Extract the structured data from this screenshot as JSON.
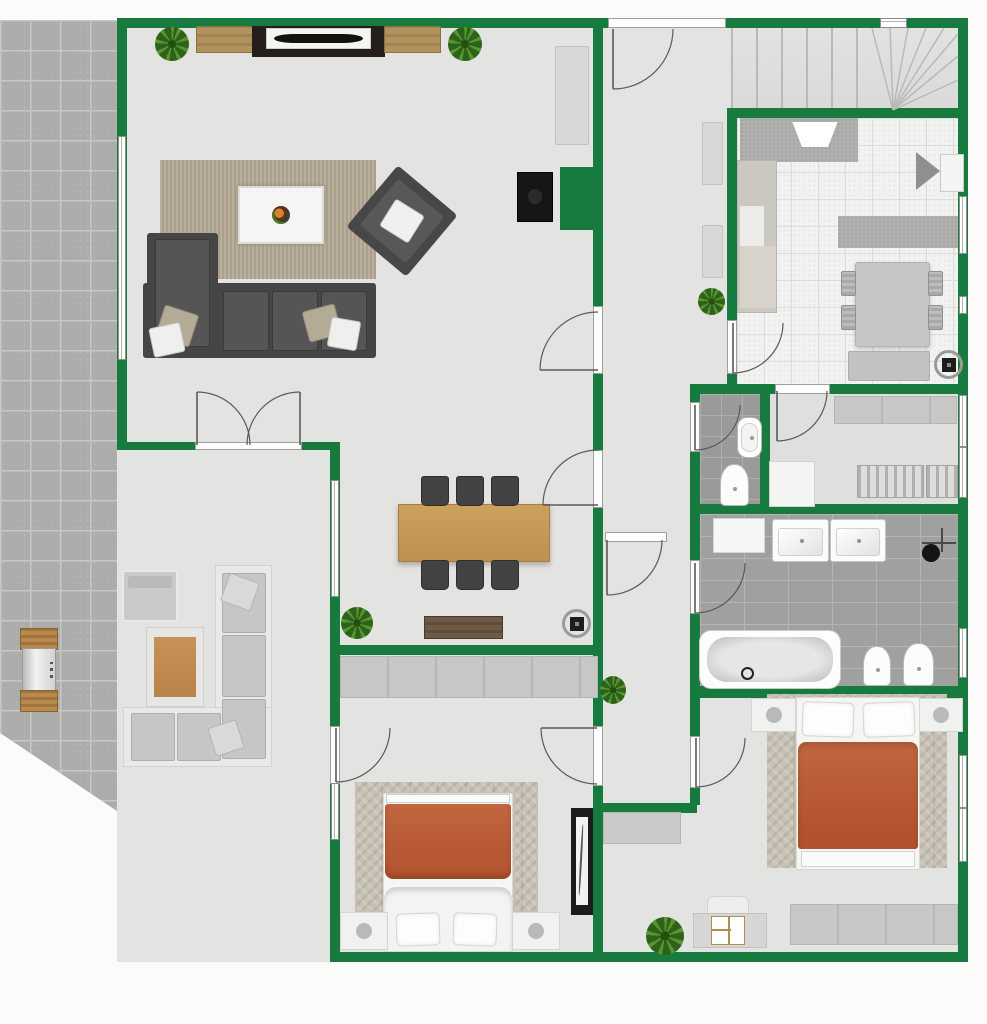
{
  "canvas": {
    "w": 987,
    "h": 1024,
    "bg": "#fbfbfa",
    "wall_color": "#177b40",
    "accent_duvet": "#b85d3a",
    "wood": "#c49a58"
  },
  "plan": {
    "patio": {
      "name": "patio-paving",
      "x": 0,
      "y": 20,
      "w": 340,
      "h": 942,
      "clip": "polygon(0px 0px,117px 0px,117px 424px,330px 424px,330px 933px,0px 713px)"
    },
    "floors": [
      {
        "n": "house-floor-base",
        "x": 117,
        "y": 18,
        "w": 851,
        "h": 944,
        "k": "fl-plain"
      },
      {
        "n": "kitchen-floor",
        "x": 737,
        "y": 118,
        "w": 221,
        "h": 266,
        "k": "fl-kitchen"
      },
      {
        "n": "wc-floor",
        "x": 700,
        "y": 394,
        "w": 60,
        "h": 110,
        "k": "fl-wc"
      },
      {
        "n": "closet-room-floor",
        "x": 770,
        "y": 394,
        "w": 188,
        "h": 110,
        "k": "fl-closet"
      },
      {
        "n": "bathroom-floor",
        "x": 700,
        "y": 514,
        "w": 258,
        "h": 172,
        "k": "fl-bath"
      },
      {
        "n": "staircase-floor",
        "x": 731,
        "y": 28,
        "w": 227,
        "h": 80,
        "k": "fl-stairs"
      },
      {
        "n": "stair-treads",
        "x": 731,
        "y": 28,
        "w": 148,
        "h": 80,
        "k": "fl-stairs treads"
      }
    ],
    "stair_rays": {
      "pivot": [
        893,
        110
      ],
      "tips": [
        [
          872,
          28
        ],
        [
          890,
          28
        ],
        [
          908,
          28
        ],
        [
          926,
          28
        ],
        [
          944,
          28
        ],
        [
          958,
          34
        ],
        [
          958,
          56
        ],
        [
          958,
          80
        ]
      ]
    },
    "walls": [
      {
        "n": "wall-top",
        "x": 117,
        "y": 18,
        "w": 851,
        "h": 10
      },
      {
        "n": "wall-right",
        "x": 958,
        "y": 18,
        "w": 10,
        "h": 944
      },
      {
        "n": "wall-bottom",
        "x": 330,
        "y": 952,
        "w": 638,
        "h": 10
      },
      {
        "n": "wall-living-left",
        "x": 117,
        "y": 18,
        "w": 10,
        "h": 432
      },
      {
        "n": "wall-living-bottom",
        "x": 117,
        "y": 442,
        "w": 221,
        "h": 8
      },
      {
        "n": "wall-west-lower",
        "x": 330,
        "y": 442,
        "w": 10,
        "h": 510
      },
      {
        "n": "wall-hall-west",
        "x": 593,
        "y": 18,
        "w": 10,
        "h": 934
      },
      {
        "n": "wall-fireplace-pier",
        "x": 560,
        "y": 167,
        "w": 43,
        "h": 63
      },
      {
        "n": "wall-bedleft-top",
        "x": 330,
        "y": 645,
        "w": 273,
        "h": 10
      },
      {
        "n": "wall-corridor-end",
        "x": 603,
        "y": 803,
        "w": 94,
        "h": 10
      },
      {
        "n": "wall-stairs-bottom",
        "x": 727,
        "y": 108,
        "w": 241,
        "h": 10
      },
      {
        "n": "wall-kitchen-west",
        "x": 727,
        "y": 118,
        "w": 10,
        "h": 276
      },
      {
        "n": "wall-kitchen-bottom",
        "x": 690,
        "y": 384,
        "w": 278,
        "h": 10
      },
      {
        "n": "wall-corridor-east",
        "x": 690,
        "y": 394,
        "w": 10,
        "h": 306
      },
      {
        "n": "wall-wc-east",
        "x": 760,
        "y": 394,
        "w": 10,
        "h": 120
      },
      {
        "n": "wall-bath-top",
        "x": 690,
        "y": 504,
        "w": 278,
        "h": 10
      },
      {
        "n": "wall-bath-bottom",
        "x": 690,
        "y": 686,
        "w": 278,
        "h": 12
      },
      {
        "n": "wall-bedright-west",
        "x": 690,
        "y": 698,
        "w": 10,
        "h": 107
      }
    ],
    "thresholds": [
      {
        "n": "entry-door-threshold",
        "x": 608,
        "y": 18,
        "w": 118,
        "h": 10
      },
      {
        "n": "living-door-threshold",
        "x": 593,
        "y": 306,
        "w": 10,
        "h": 68
      },
      {
        "n": "dining-door-threshold",
        "x": 593,
        "y": 450,
        "w": 10,
        "h": 58
      },
      {
        "n": "corridor-door-threshold",
        "x": 605,
        "y": 532,
        "w": 62,
        "h": 10
      },
      {
        "n": "kitchen-door-threshold",
        "x": 727,
        "y": 320,
        "w": 10,
        "h": 54
      },
      {
        "n": "pantry-door-threshold",
        "x": 775,
        "y": 384,
        "w": 55,
        "h": 10
      },
      {
        "n": "wc-door-threshold",
        "x": 690,
        "y": 402,
        "w": 10,
        "h": 50
      },
      {
        "n": "bath-door-threshold",
        "x": 690,
        "y": 560,
        "w": 10,
        "h": 54
      },
      {
        "n": "bedleft-patio-door-threshold",
        "x": 330,
        "y": 726,
        "w": 10,
        "h": 58
      },
      {
        "n": "bedleft-door-threshold",
        "x": 593,
        "y": 726,
        "w": 10,
        "h": 60
      },
      {
        "n": "bedright-door-threshold",
        "x": 690,
        "y": 736,
        "w": 10,
        "h": 52
      },
      {
        "n": "patio-double-door-threshold",
        "x": 195,
        "y": 442,
        "w": 107,
        "h": 8
      }
    ],
    "windows": [
      {
        "n": "living-window",
        "x": 118,
        "y": 136,
        "w": 8,
        "h": 224,
        "o": "v"
      },
      {
        "n": "dining-window",
        "x": 331,
        "y": 480,
        "w": 8,
        "h": 117,
        "o": "v"
      },
      {
        "n": "bedleft-window",
        "x": 331,
        "y": 783,
        "w": 8,
        "h": 57,
        "o": "v"
      },
      {
        "n": "stairs-top-window",
        "x": 880,
        "y": 18,
        "w": 27,
        "h": 10,
        "o": "h"
      },
      {
        "n": "kitchen-window-1",
        "x": 959,
        "y": 196,
        "w": 8,
        "h": 58,
        "o": "v"
      },
      {
        "n": "kitchen-window-2",
        "x": 959,
        "y": 296,
        "w": 8,
        "h": 18,
        "o": "v"
      },
      {
        "n": "closet-window-1",
        "x": 959,
        "y": 395,
        "w": 8,
        "h": 52,
        "o": "v"
      },
      {
        "n": "closet-window-2",
        "x": 959,
        "y": 447,
        "w": 8,
        "h": 51,
        "o": "v"
      },
      {
        "n": "bath-window",
        "x": 959,
        "y": 628,
        "w": 8,
        "h": 50,
        "o": "v"
      },
      {
        "n": "bedright-window-1",
        "x": 959,
        "y": 755,
        "w": 8,
        "h": 53,
        "o": "v"
      },
      {
        "n": "bedright-window-2",
        "x": 959,
        "y": 808,
        "w": 8,
        "h": 54,
        "o": "v"
      }
    ],
    "doors": [
      {
        "n": "entry-door",
        "hx": 613,
        "hy": 29,
        "r": 60,
        "a1": 0,
        "leaf": "end"
      },
      {
        "n": "living-door",
        "hx": 598,
        "hy": 370,
        "r": 58,
        "a1": 180,
        "leaf": "start"
      },
      {
        "n": "dining-door",
        "hx": 598,
        "hy": 505,
        "r": 55,
        "a1": 180,
        "leaf": "start"
      },
      {
        "n": "corridor-door",
        "hx": 607,
        "hy": 540,
        "r": 55,
        "a1": 0,
        "leaf": "end"
      },
      {
        "n": "kitchen-door",
        "hx": 733,
        "hy": 323,
        "r": 50,
        "a1": 0,
        "leaf": "end"
      },
      {
        "n": "pantry-door",
        "hx": 777,
        "hy": 391,
        "r": 50,
        "a1": 0,
        "leaf": "end"
      },
      {
        "n": "wc-door",
        "hx": 695,
        "hy": 405,
        "r": 45,
        "a1": 0,
        "leaf": "end"
      },
      {
        "n": "bathroom-door",
        "hx": 695,
        "hy": 563,
        "r": 50,
        "a1": 0,
        "leaf": "end"
      },
      {
        "n": "bedleft-patio-door",
        "hx": 336,
        "hy": 728,
        "r": 54,
        "a1": 0,
        "leaf": "end"
      },
      {
        "n": "bedleft-door",
        "hx": 597,
        "hy": 728,
        "r": 56,
        "a1": 90,
        "leaf": "end"
      },
      {
        "n": "bedright-door",
        "hx": 696,
        "hy": 738,
        "r": 49,
        "a1": 0,
        "leaf": "end"
      },
      {
        "n": "patio-door-left-leaf",
        "hx": 197,
        "hy": 445,
        "r": 53,
        "a1": 270,
        "leaf": "start"
      },
      {
        "n": "patio-door-right-leaf",
        "hx": 300,
        "hy": 445,
        "r": 53,
        "a1": 180,
        "leaf": "end"
      }
    ],
    "furniture": [
      {
        "t": "plant",
        "n": "living-plant-left",
        "x": 155,
        "y": 27,
        "w": 34,
        "h": 34
      },
      {
        "t": "sideboard-wood",
        "n": "tv-sideboard-left",
        "x": 196,
        "y": 26,
        "w": 57,
        "h": 27
      },
      {
        "t": "media-console",
        "n": "tv-console",
        "x": 252,
        "y": 26,
        "w": 133,
        "h": 31
      },
      {
        "t": "sideboard-wood",
        "n": "tv-sideboard-right",
        "x": 384,
        "y": 26,
        "w": 57,
        "h": 27
      },
      {
        "t": "plant",
        "n": "living-plant-right",
        "x": 448,
        "y": 27,
        "w": 34,
        "h": 34
      },
      {
        "t": "cabinet",
        "n": "living-cabinet",
        "x": 555,
        "y": 46,
        "w": 34,
        "h": 99
      },
      {
        "t": "fireplace",
        "n": "wall-stove",
        "x": 517,
        "y": 172,
        "w": 36,
        "h": 50
      },
      {
        "t": "rug-living",
        "n": "living-rug",
        "x": 160,
        "y": 160,
        "w": 216,
        "h": 119
      },
      {
        "t": "sofa-l",
        "n": "living-sofa",
        "x": 143,
        "y": 233,
        "w": 233,
        "h": 125
      },
      {
        "t": "armchair",
        "n": "living-armchair",
        "x": 363,
        "y": 181,
        "w": 78,
        "h": 80
      },
      {
        "t": "table-wood",
        "n": "dining-table",
        "x": 398,
        "y": 504,
        "w": 152,
        "h": 58
      },
      {
        "t": "chair-dark",
        "n": "dining-chair",
        "x": 421,
        "y": 476,
        "w": 28,
        "h": 30
      },
      {
        "t": "chair-dark",
        "n": "dining-chair",
        "x": 456,
        "y": 476,
        "w": 28,
        "h": 30
      },
      {
        "t": "chair-dark",
        "n": "dining-chair",
        "x": 491,
        "y": 476,
        "w": 28,
        "h": 30
      },
      {
        "t": "chair-dark",
        "n": "dining-chair",
        "x": 421,
        "y": 560,
        "w": 28,
        "h": 30
      },
      {
        "t": "chair-dark",
        "n": "dining-chair",
        "x": 456,
        "y": 560,
        "w": 28,
        "h": 30
      },
      {
        "t": "chair-dark",
        "n": "dining-chair",
        "x": 491,
        "y": 560,
        "w": 28,
        "h": 30
      },
      {
        "t": "sideboard-dark",
        "n": "dining-sideboard",
        "x": 424,
        "y": 616,
        "w": 79,
        "h": 23
      },
      {
        "t": "plant",
        "n": "dining-plant",
        "x": 341,
        "y": 607,
        "w": 32,
        "h": 32
      },
      {
        "t": "stove-round",
        "n": "dining-round-stove",
        "x": 562,
        "y": 609,
        "w": 29,
        "h": 29
      },
      {
        "t": "cabinet",
        "n": "hall-cabinet-1",
        "x": 702,
        "y": 122,
        "w": 21,
        "h": 63
      },
      {
        "t": "cabinet",
        "n": "hall-cabinet-2",
        "x": 702,
        "y": 225,
        "w": 21,
        "h": 53
      },
      {
        "t": "plant",
        "n": "hall-plant",
        "x": 698,
        "y": 288,
        "w": 27,
        "h": 27
      },
      {
        "t": "plant",
        "n": "corridor-plant",
        "x": 600,
        "y": 676,
        "w": 26,
        "h": 28
      },
      {
        "t": "counter",
        "n": "kitchen-counter-top",
        "x": 740,
        "y": 118,
        "w": 118,
        "h": 44
      },
      {
        "t": "hood",
        "n": "kitchen-hood",
        "x": 788,
        "y": 122,
        "w": 54,
        "h": 32
      },
      {
        "t": "counter-left",
        "n": "kitchen-counter-left",
        "x": 737,
        "y": 160,
        "w": 40,
        "h": 153
      },
      {
        "t": "counter",
        "n": "kitchen-island",
        "x": 838,
        "y": 216,
        "w": 120,
        "h": 32
      },
      {
        "t": "kcorner",
        "n": "kitchen-corner-appliance",
        "x": 916,
        "y": 150,
        "w": 48,
        "h": 42
      },
      {
        "t": "ktable",
        "n": "kitchen-table",
        "x": 855,
        "y": 262,
        "w": 75,
        "h": 85
      },
      {
        "t": "kchair",
        "n": "kitchen-chair",
        "x": 841,
        "y": 271,
        "w": 15,
        "h": 25
      },
      {
        "t": "kchair",
        "n": "kitchen-chair",
        "x": 841,
        "y": 305,
        "w": 15,
        "h": 25
      },
      {
        "t": "kchair",
        "n": "kitchen-chair",
        "x": 928,
        "y": 271,
        "w": 15,
        "h": 25
      },
      {
        "t": "kchair",
        "n": "kitchen-chair",
        "x": 928,
        "y": 305,
        "w": 15,
        "h": 25
      },
      {
        "t": "bench",
        "n": "kitchen-bench",
        "x": 848,
        "y": 351,
        "w": 82,
        "h": 30
      },
      {
        "t": "stove-round",
        "n": "kitchen-round-stove",
        "x": 934,
        "y": 350,
        "w": 29,
        "h": 29
      },
      {
        "t": "sink-oval",
        "n": "wc-sink",
        "x": 737,
        "y": 417,
        "w": 25,
        "h": 41
      },
      {
        "t": "toilet",
        "n": "wc-toilet",
        "x": 720,
        "y": 464,
        "w": 29,
        "h": 42
      },
      {
        "t": "wardrobe",
        "n": "closet-wardrobe",
        "x": 834,
        "y": 396,
        "w": 123,
        "h": 28
      },
      {
        "t": "dresser-white",
        "n": "closet-dresser",
        "x": 769,
        "y": 461,
        "w": 46,
        "h": 46
      },
      {
        "t": "slat-shelf",
        "n": "closet-shelf-1",
        "x": 857,
        "y": 465,
        "w": 67,
        "h": 33
      },
      {
        "t": "slat-shelf",
        "n": "closet-shelf-2",
        "x": 926,
        "y": 465,
        "w": 32,
        "h": 33
      },
      {
        "t": "cabinet-white",
        "n": "bath-cabinet",
        "x": 713,
        "y": 518,
        "w": 52,
        "h": 35
      },
      {
        "t": "sink-sq",
        "n": "bath-sink-1",
        "x": 772,
        "y": 519,
        "w": 57,
        "h": 43
      },
      {
        "t": "sink-sq",
        "n": "bath-sink-2",
        "x": 830,
        "y": 519,
        "w": 56,
        "h": 43
      },
      {
        "t": "shower",
        "n": "bath-shower",
        "x": 922,
        "y": 528,
        "w": 34,
        "h": 34
      },
      {
        "t": "bathtub",
        "n": "bathtub",
        "x": 699,
        "y": 630,
        "w": 142,
        "h": 59
      },
      {
        "t": "toilet",
        "n": "bath-bidet",
        "x": 863,
        "y": 646,
        "w": 28,
        "h": 40
      },
      {
        "t": "toilet",
        "n": "bath-toilet",
        "x": 903,
        "y": 643,
        "w": 31,
        "h": 43
      },
      {
        "t": "wardrobe",
        "n": "bedleft-wardrobe",
        "x": 340,
        "y": 656,
        "w": 258,
        "h": 42
      },
      {
        "t": "rug-herr",
        "n": "bedleft-rug",
        "x": 355,
        "y": 782,
        "w": 183,
        "h": 136
      },
      {
        "t": "bed-up",
        "n": "bedleft-bed",
        "x": 383,
        "y": 793,
        "w": 130,
        "h": 159
      },
      {
        "t": "nightstand",
        "n": "bedleft-nightstand-1",
        "x": 340,
        "y": 912,
        "w": 48,
        "h": 38
      },
      {
        "t": "nightstand",
        "n": "bedleft-nightstand-2",
        "x": 512,
        "y": 912,
        "w": 48,
        "h": 38
      },
      {
        "t": "mirror",
        "n": "standing-mirror",
        "x": 571,
        "y": 808,
        "w": 22,
        "h": 107
      },
      {
        "t": "rug-herr",
        "n": "bedright-rug",
        "x": 767,
        "y": 694,
        "w": 180,
        "h": 174
      },
      {
        "t": "nightstand",
        "n": "bedright-nightstand-1",
        "x": 751,
        "y": 698,
        "w": 45,
        "h": 34
      },
      {
        "t": "nightstand",
        "n": "bedright-nightstand-2",
        "x": 919,
        "y": 698,
        "w": 44,
        "h": 34
      },
      {
        "t": "bed-down",
        "n": "bedright-bed",
        "x": 796,
        "y": 697,
        "w": 124,
        "h": 173
      },
      {
        "t": "dresser-gray",
        "n": "bedright-dresser",
        "x": 603,
        "y": 812,
        "w": 78,
        "h": 32
      },
      {
        "t": "desk-set",
        "n": "bedright-desk",
        "x": 693,
        "y": 896,
        "w": 74,
        "h": 54
      },
      {
        "t": "plant",
        "n": "bedright-plant",
        "x": 646,
        "y": 917,
        "w": 38,
        "h": 38
      },
      {
        "t": "wardrobe",
        "n": "bedright-wardrobe",
        "x": 790,
        "y": 904,
        "w": 168,
        "h": 41
      },
      {
        "t": "grill",
        "n": "patio-grill",
        "x": 20,
        "y": 628,
        "w": 38,
        "h": 84
      },
      {
        "t": "out-armchair",
        "n": "patio-armchair",
        "x": 122,
        "y": 570,
        "w": 56,
        "h": 52
      },
      {
        "t": "out-table",
        "n": "patio-table",
        "x": 146,
        "y": 627,
        "w": 58,
        "h": 80
      },
      {
        "t": "out-sofa",
        "n": "patio-sofa",
        "x": 123,
        "y": 565,
        "w": 149,
        "h": 202
      }
    ]
  }
}
